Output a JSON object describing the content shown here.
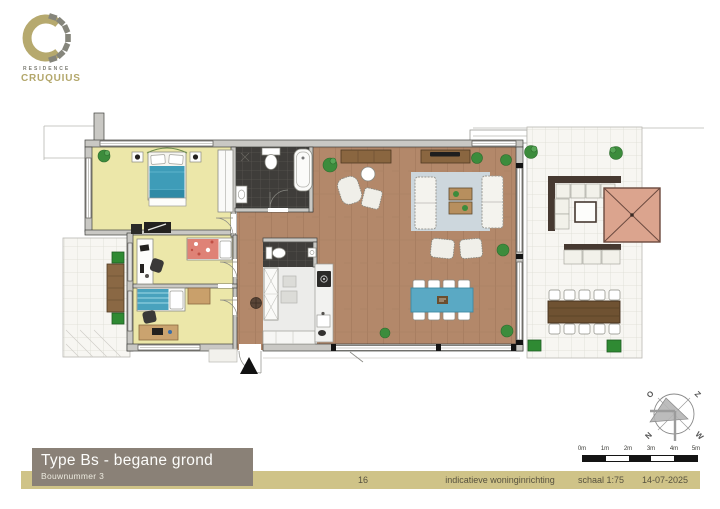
{
  "logo": {
    "name_top": "RESIDENCE",
    "name_bottom": "CRUQUIUS"
  },
  "title_block": {
    "title": "Type Bs - begane grond",
    "subtitle": "Bouwnummer 3"
  },
  "footer": {
    "page_number": "16",
    "note": "indicatieve woninginrichting",
    "scale_label": "schaal 1:75",
    "date": "14-07-2025"
  },
  "scale_bar": {
    "labels": [
      "0m",
      "1m",
      "2m",
      "3m",
      "4m",
      "5m"
    ]
  },
  "compass": {
    "east": "O",
    "south": "Z",
    "north": "N",
    "west": "W"
  },
  "colors": {
    "accent_tan": "#cfc388",
    "title_gray": "#8a8177",
    "logo_gold": "#b6a96e",
    "bedroom_floor": "#ece7a9",
    "wood_floor": "#b3886a",
    "terrace_tile": "#f7f6f2",
    "bathroom_tile": "#3f3d3a",
    "water_blue": "#4aa2bd",
    "parasol": "#dba48e",
    "plant_green": "#3c8c3c"
  }
}
